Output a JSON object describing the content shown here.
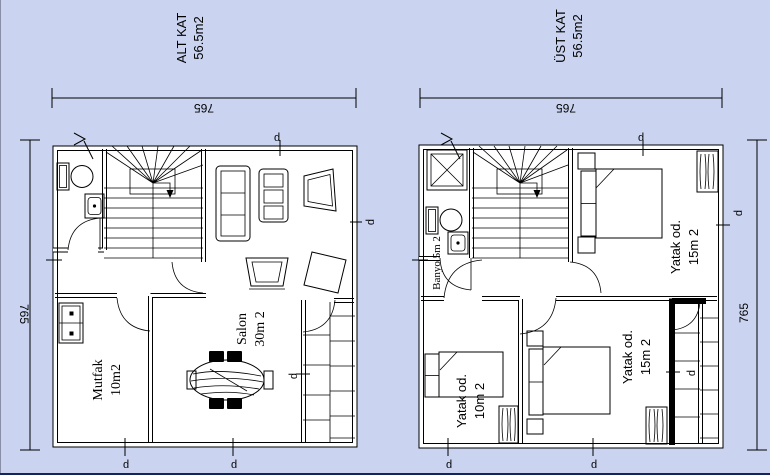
{
  "canvas": {
    "background": "#cad4f0",
    "paper": "#ffffff",
    "line": "#000000",
    "left_edge": "#8a8fa8",
    "bottom_edge": "#16245c"
  },
  "plans": {
    "alt": {
      "title": "ALT KAT",
      "area": "56.5m2",
      "dim_width": "765",
      "dim_height": "765",
      "window_marker": "p",
      "entry_marker": "v",
      "rooms": {
        "kitchen": {
          "label": "Mutfak",
          "area": "10m2"
        },
        "living": {
          "label": "Salon",
          "area": "30m 2"
        }
      }
    },
    "ust": {
      "title": "ÜST KAT",
      "area": "56.5m2",
      "dim_width": "765",
      "dim_height": "765",
      "window_marker": "p",
      "entry_marker": "v",
      "rooms": {
        "bathroom": {
          "label": "Banyo 5m 2"
        },
        "bedroom_top": {
          "label": "Yatak od.",
          "area": "15m 2"
        },
        "bedroom_small": {
          "label": "Yatak od.",
          "area": "10m 2"
        },
        "bedroom_bottom": {
          "label": "Yatak od.",
          "area": "15m 2"
        }
      }
    }
  }
}
